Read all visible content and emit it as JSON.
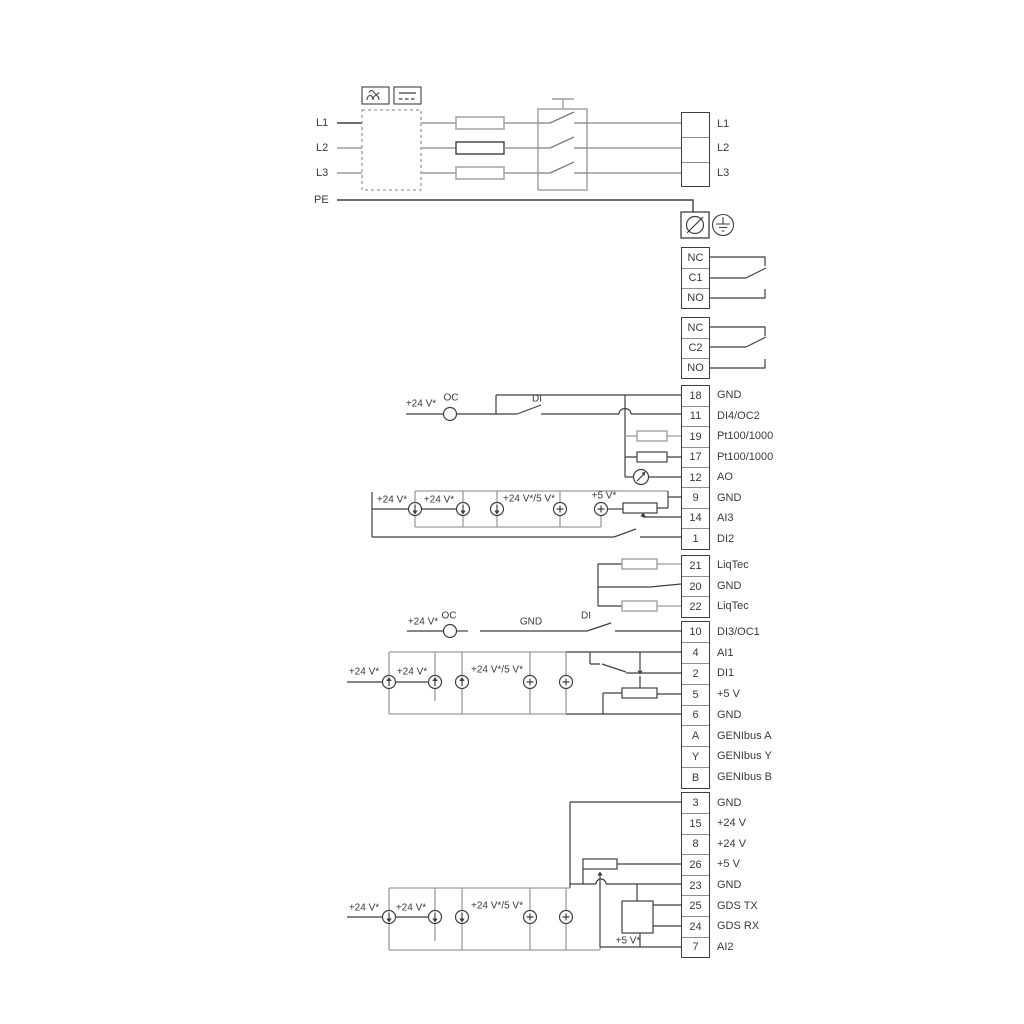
{
  "power": {
    "inputs": {
      "l1": "L1",
      "l2": "L2",
      "l3": "L3",
      "pe": "PE"
    },
    "outputs": {
      "l1": "L1",
      "l2": "L2",
      "l3": "L3"
    }
  },
  "relay1": {
    "nc": "NC",
    "c": "C1",
    "no": "NO"
  },
  "relay2": {
    "nc": "NC",
    "c": "C2",
    "no": "NO"
  },
  "io1": {
    "rows": [
      {
        "n": "18",
        "label": "GND"
      },
      {
        "n": "11",
        "label": "DI4/OC2"
      },
      {
        "n": "19",
        "label": "Pt100/1000"
      },
      {
        "n": "17",
        "label": "Pt100/1000"
      },
      {
        "n": "12",
        "label": "AO"
      },
      {
        "n": "9",
        "label": "GND"
      },
      {
        "n": "14",
        "label": "AI3"
      },
      {
        "n": "1",
        "label": "DI2"
      }
    ]
  },
  "liqtec": {
    "rows": [
      {
        "n": "21",
        "label": "LiqTec"
      },
      {
        "n": "20",
        "label": "GND"
      },
      {
        "n": "22",
        "label": "LiqTec"
      }
    ]
  },
  "io2": {
    "rows": [
      {
        "n": "10",
        "label": "DI3/OC1"
      },
      {
        "n": "4",
        "label": "AI1"
      },
      {
        "n": "2",
        "label": "DI1"
      },
      {
        "n": "5",
        "label": "+5 V"
      },
      {
        "n": "6",
        "label": "GND"
      },
      {
        "n": "A",
        "label": "GENIbus A"
      },
      {
        "n": "Y",
        "label": "GENIbus Y"
      },
      {
        "n": "B",
        "label": "GENIbus B"
      }
    ]
  },
  "io3": {
    "rows": [
      {
        "n": "3",
        "label": "GND"
      },
      {
        "n": "15",
        "label": "+24 V"
      },
      {
        "n": "8",
        "label": "+24 V"
      },
      {
        "n": "26",
        "label": "+5 V"
      },
      {
        "n": "23",
        "label": "GND"
      },
      {
        "n": "25",
        "label": "GDS TX"
      },
      {
        "n": "24",
        "label": "GDS RX"
      },
      {
        "n": "7",
        "label": "AI2"
      }
    ]
  },
  "labels": {
    "v24": "+24 V*",
    "v24_5": "+24 V*/5 V*",
    "v5": "+5 V*",
    "oc": "OC",
    "di": "DI",
    "gnd": "GND"
  },
  "colors": {
    "line_gray": "#9c9c9c",
    "line_dark": "#3f3f3f",
    "text": "#3a3a3a"
  }
}
